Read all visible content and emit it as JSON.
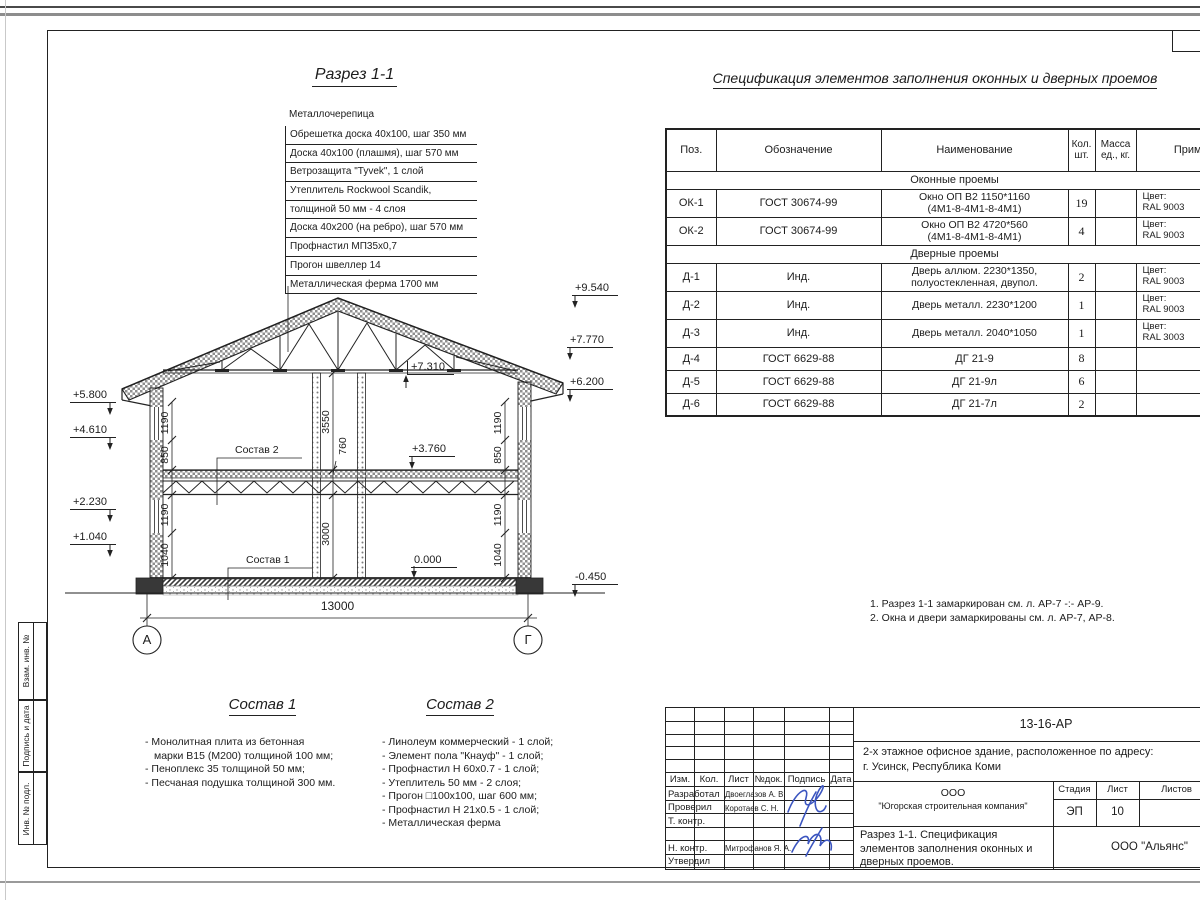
{
  "sheet": {
    "margin_labels": [
      "Взам. инв. №",
      "Подпись и дата",
      "Инв. № подл."
    ]
  },
  "section_view": {
    "title": "Разрез 1-1",
    "roof_callout": {
      "top_label": "Металлочерепица",
      "items": [
        "Обрешетка доска 40х100, шаг 350 мм",
        "Доска 40х100 (плашмя), шаг 570 мм",
        "Ветрозащита \"Tyvek\", 1 слой",
        "Утеплитель Rockwool Scandik,",
        "толщиной 50 мм - 4 слоя",
        "Доска 40х200 (на ребро), шаг 570 мм",
        "Профнастил МП35х0,7",
        "Прогон швеллер 14",
        "Металлическая ферма 1700 мм"
      ]
    },
    "elevation_marks": {
      "left": [
        "+5.800",
        "+4.610",
        "+2.230",
        "+1.040"
      ],
      "right": [
        "+9.540",
        "+7.770",
        "+6.200",
        "-0.450"
      ],
      "interior": [
        "+7.310",
        "+3.760",
        "0.000"
      ]
    },
    "dimensions": {
      "width": "13000",
      "floor2_height": "3550",
      "floor_thickness": "760",
      "floor1_height": "3000",
      "wall_upper": [
        "1190",
        "850"
      ],
      "wall_lower": [
        "1190",
        "1040"
      ]
    },
    "axes": [
      "А",
      "Г"
    ]
  },
  "spec_table": {
    "title": "Спецификация элементов заполнения оконных и дверных проемов",
    "header": {
      "pos": "Поз.",
      "designation": "Обозначение",
      "name": "Наименование",
      "qty1": "Кол.",
      "qty2": "шт.",
      "mass1": "Масса",
      "mass2": "ед., кг.",
      "note": "Прим."
    },
    "sections": [
      {
        "title": "Оконные проемы",
        "rows": [
          {
            "pos": "ОК-1",
            "designation": "ГОСТ 30674-99",
            "name1": "Окно ОП В2 1150*1160",
            "name2": "(4М1-8-4М1-8-4М1)",
            "qty": "19",
            "mass": "",
            "note1": "Цвет:",
            "note2": "RAL 9003"
          },
          {
            "pos": "ОК-2",
            "designation": "ГОСТ 30674-99",
            "name1": "Окно ОП В2 4720*560",
            "name2": "(4М1-8-4М1-8-4М1)",
            "qty": "4",
            "mass": "",
            "note1": "Цвет:",
            "note2": "RAL 9003"
          }
        ]
      },
      {
        "title": "Дверные проемы",
        "rows": [
          {
            "pos": "Д-1",
            "designation": "Инд.",
            "name1": "Дверь аллюм. 2230*1350,",
            "name2": "полуостекленная, двупол.",
            "qty": "2",
            "mass": "",
            "note1": "Цвет:",
            "note2": "RAL 9003"
          },
          {
            "pos": "Д-2",
            "designation": "Инд.",
            "name1": "Дверь металл. 2230*1200",
            "name2": "",
            "qty": "1",
            "mass": "",
            "note1": "Цвет:",
            "note2": "RAL 9003"
          },
          {
            "pos": "Д-3",
            "designation": "Инд.",
            "name1": "Дверь металл. 2040*1050",
            "name2": "",
            "qty": "1",
            "mass": "",
            "note1": "Цвет:",
            "note2": "RAL 3003"
          },
          {
            "pos": "Д-4",
            "designation": "ГОСТ 6629-88",
            "name1": "ДГ 21-9",
            "name2": "",
            "qty": "8",
            "mass": "",
            "note1": "",
            "note2": ""
          },
          {
            "pos": "Д-5",
            "designation": "ГОСТ 6629-88",
            "name1": "ДГ 21-9л",
            "name2": "",
            "qty": "6",
            "mass": "",
            "note1": "",
            "note2": ""
          },
          {
            "pos": "Д-6",
            "designation": "ГОСТ 6629-88",
            "name1": "ДГ 21-7л",
            "name2": "",
            "qty": "2",
            "mass": "",
            "note1": "",
            "note2": ""
          }
        ]
      }
    ]
  },
  "notes": [
    "1. Разрез 1-1 замаркирован см. л. АР-7 -:- АР-9.",
    "2. Окна и двери замаркированы см. л. АР-7, АР-8."
  ],
  "compositions": {
    "sostav1": {
      "title": "Состав 1",
      "lines": [
        "- Монолитная плита из бетонная",
        "марки В15 (М200) толщиной 100 мм;",
        "- Пеноплекс 35 толщиной 50 мм;",
        "- Песчаная подушка толщиной 300 мм."
      ]
    },
    "sostav2": {
      "title": "Состав 2",
      "lines": [
        "- Линолеум коммерческий - 1 слой;",
        "- Элемент пола \"Кнауф\"    - 1 слой;",
        "- Профнастил Н 60х0.7      - 1 слой;",
        "- Утеплитель 50 мм            - 2 слоя;",
        "- Прогон □100х100, шаг 600 мм;",
        "- Профнастил Н 21х0.5      - 1 слой;",
        "- Металлическая ферма"
      ]
    }
  },
  "title_block": {
    "doc_number": "13-16-АР",
    "project_line1": "2-х этажное офисное здание, расположенное по адресу:",
    "project_line2": "г. Усинск, Республика Коми",
    "company_line1": "ООО",
    "company_line2": "\"Югорская строительная компания\"",
    "stage_label": "Стадия",
    "sheet_label": "Лист",
    "sheets_label": "Листов",
    "stage_value": "ЭП",
    "sheet_value": "10",
    "sheet_title_line1": "Разрез 1-1. Спецификация",
    "sheet_title_line2": "элементов заполнения оконных и",
    "sheet_title_line3": "дверных проемов.",
    "contractor": "ООО \"Альянс\"",
    "header": [
      "Изм.",
      "Кол.",
      "Лист",
      "№док.",
      "Подпись",
      "Дата"
    ],
    "rows": [
      {
        "role": "Разработал",
        "name": "Двоеглазов А. В."
      },
      {
        "role": "Проверил",
        "name": "Коротаев С. Н."
      },
      {
        "role": "Т. контр.",
        "name": ""
      },
      {
        "role": "",
        "name": ""
      },
      {
        "role": "Н. контр.",
        "name": "Митрофанов Я. А."
      },
      {
        "role": "Утвердил",
        "name": ""
      }
    ],
    "ink_color": "#3b55c0"
  }
}
